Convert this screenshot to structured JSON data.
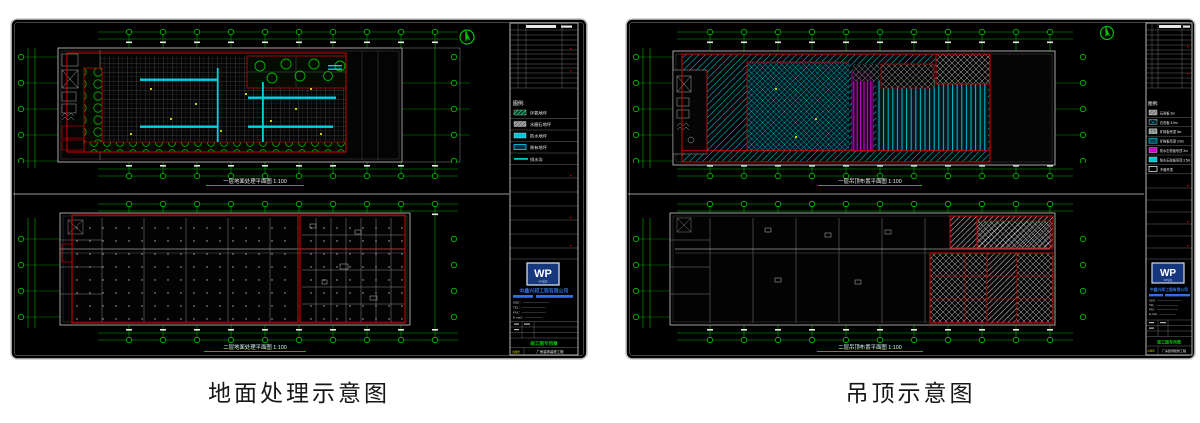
{
  "captions": {
    "left": "地面处理示意图",
    "right": "吊顶示意图"
  },
  "left_panel": {
    "plan_top_title": "一层地面处理平面图 1:100",
    "plan_bottom_title": "二层地面处理平面图 1:100",
    "legend_title": "图例:",
    "legend": [
      {
        "name": "green-hatch-swatch",
        "label": "环氧地坪"
      },
      {
        "name": "gray-hatch-swatch",
        "label": "水磨石地坪"
      },
      {
        "name": "cyan-solid-swatch",
        "label": "防水地坪"
      },
      {
        "name": "teal-outline-swatch",
        "label": "原有地坪"
      },
      {
        "name": "cyan-line-swatch",
        "label": "排水沟"
      }
    ]
  },
  "right_panel": {
    "plan_top_title": "一层吊顶布置平面图 1:100",
    "plan_bottom_title": "二层吊顶布置平面图 1:100",
    "legend_title": "图例:",
    "legend": [
      {
        "name": "light-hatch-swatch",
        "label": "石膏板 3m"
      },
      {
        "name": "cyan-crosshatch-swatch",
        "label": "石膏板 3.9m"
      },
      {
        "name": "gray-dot-swatch",
        "label": "矿棉板吊顶 3m"
      },
      {
        "name": "teal-solid-swatch",
        "label": "矿棉板吊顶 3.5m"
      },
      {
        "name": "magenta-solid-swatch",
        "label": "防水石膏板吊顶 3m"
      },
      {
        "name": "cyan-solid-swatch",
        "label": "防水石膏板吊顶 3.5m"
      },
      {
        "name": "white-outline-swatch",
        "label": "不做吊顶"
      }
    ]
  },
  "titleblock": {
    "logo": "WP",
    "logo_sub": "WP装饰",
    "company": "中鑫兴邦工程有限公司",
    "address_lines": [
      "ADD：—————————",
      "TEL：————————",
      "FAX：————————",
      "E-mail：——————"
    ],
    "stamp": "竣工图专用章",
    "plate_label": "出图章",
    "project": "厂房装饰装修工程"
  },
  "colors": {
    "grid_green": "#00B400",
    "outline_red": "#D40000",
    "hatch_cyan": "#00C3D6",
    "hatch_magenta": "#CF00CF",
    "logo_blue": "#16377C",
    "company_blue": "#2F6FE4",
    "paper_black": "#000000"
  }
}
